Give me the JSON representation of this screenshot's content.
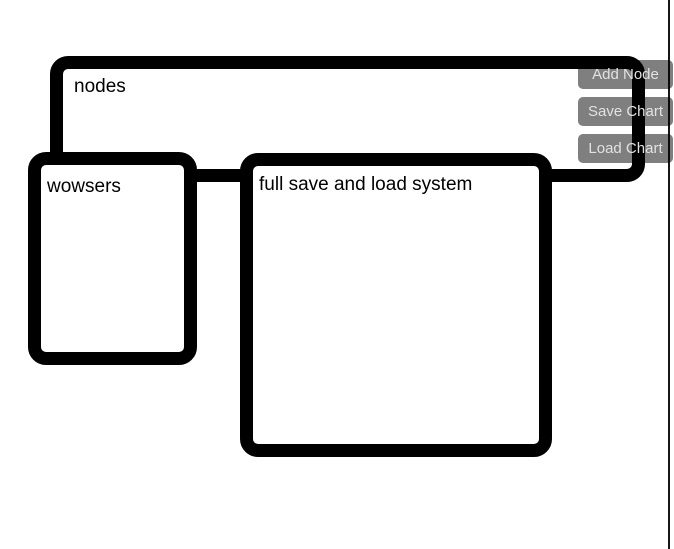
{
  "canvas": {
    "background_color": "#ffffff",
    "border_color": "#000000"
  },
  "graph": {
    "group_node": {
      "label": "nodes"
    },
    "nodes": [
      {
        "label": "wowsers"
      },
      {
        "label": "full save and load system"
      }
    ]
  },
  "toolbar": {
    "buttons": [
      {
        "label": "Add Node"
      },
      {
        "label": "Save Chart"
      },
      {
        "label": "Load Chart"
      }
    ],
    "button_bg": "rgba(0,0,0,0.5)",
    "button_text_color": "#e2e2e2"
  },
  "scrollbar": {
    "color": "#161616"
  }
}
